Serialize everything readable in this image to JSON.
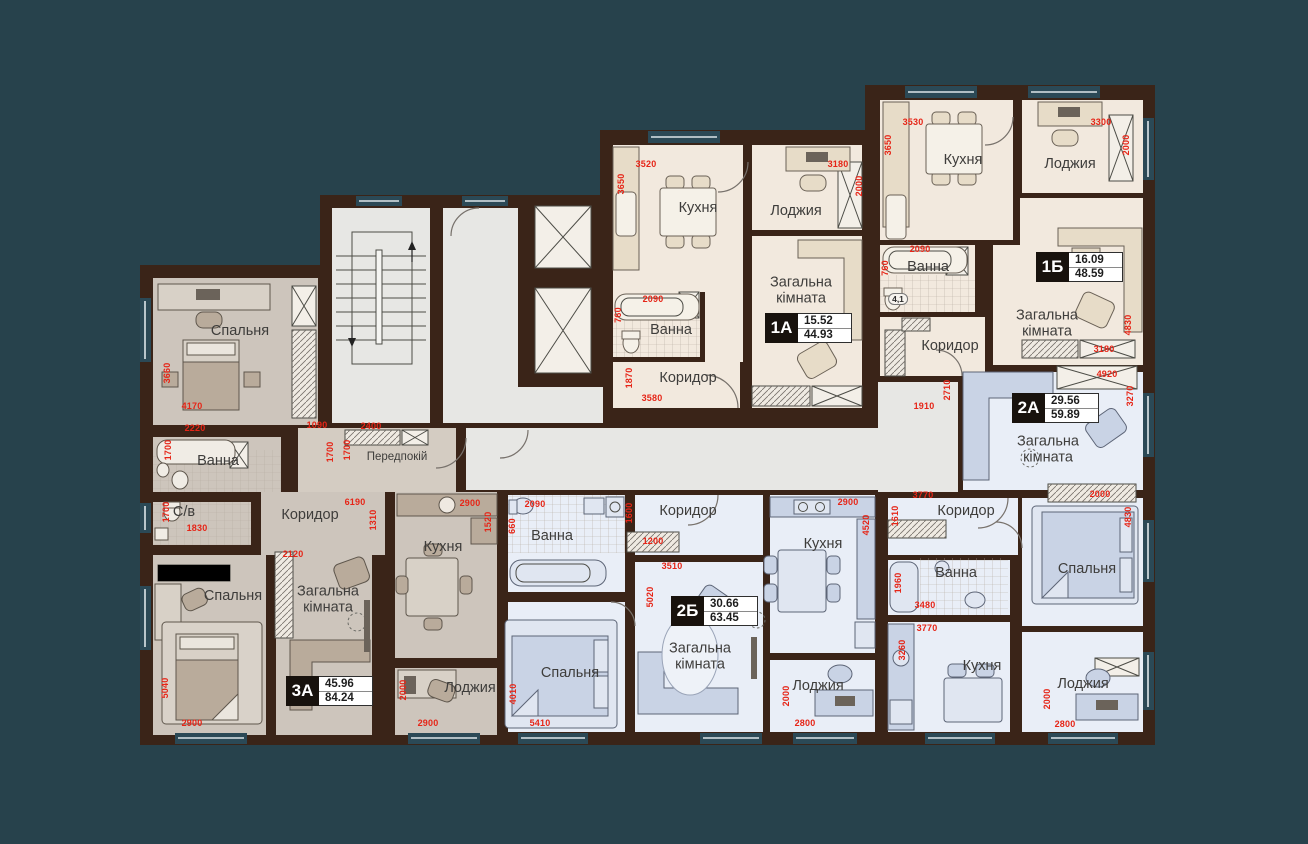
{
  "colors": {
    "background": "#27424c",
    "walls": "#3a2418",
    "dimension_red": "#e62517",
    "floor_beige": "#f2e9de",
    "floor_blue": "#e9eef7",
    "floor_warm_gray": "#cdc5bc",
    "floor_common": "#e7e7e4"
  },
  "apartments": [
    {
      "code": "1А",
      "living_area": "15.52",
      "total_area": "44.93"
    },
    {
      "code": "1Б",
      "living_area": "16.09",
      "total_area": "48.59"
    },
    {
      "code": "2А",
      "living_area": "29.56",
      "total_area": "59.89"
    },
    {
      "code": "2Б",
      "living_area": "30.66",
      "total_area": "63.45"
    },
    {
      "code": "3А",
      "living_area": "45.96",
      "total_area": "84.24"
    }
  ],
  "badges": [
    {
      "code": "1А",
      "living": "15.52",
      "total": "44.93",
      "x": 765,
      "y": 313
    },
    {
      "code": "1Б",
      "living": "16.09",
      "total": "48.59",
      "x": 1036,
      "y": 252
    },
    {
      "code": "2А",
      "living": "29.56",
      "total": "59.89",
      "x": 1012,
      "y": 393
    },
    {
      "code": "2Б",
      "living": "30.66",
      "total": "63.45",
      "x": 671,
      "y": 596
    },
    {
      "code": "3А",
      "living": "45.96",
      "total": "84.24",
      "x": 286,
      "y": 676
    }
  ],
  "room_labels": [
    {
      "t": "Кухня",
      "x": 698,
      "y": 209
    },
    {
      "t": "Лоджия",
      "x": 796,
      "y": 212
    },
    {
      "t": "Загальна\nкімната",
      "x": 801,
      "y": 291
    },
    {
      "t": "Ванна",
      "x": 671,
      "y": 331
    },
    {
      "t": "Коридор",
      "x": 688,
      "y": 379
    },
    {
      "t": "Кухня",
      "x": 963,
      "y": 161
    },
    {
      "t": "Лоджия",
      "x": 1070,
      "y": 165
    },
    {
      "t": "Загальна\nкімната",
      "x": 1047,
      "y": 324
    },
    {
      "t": "Ванна",
      "x": 928,
      "y": 268
    },
    {
      "t": "Коридор",
      "x": 950,
      "y": 347
    },
    {
      "t": "Загальна\nкімната",
      "x": 1048,
      "y": 450
    },
    {
      "t": "Коридор",
      "x": 966,
      "y": 512
    },
    {
      "t": "Ванна",
      "x": 956,
      "y": 574
    },
    {
      "t": "Кухня",
      "x": 982,
      "y": 667
    },
    {
      "t": "Спальня",
      "x": 1087,
      "y": 570
    },
    {
      "t": "Лоджия",
      "x": 1083,
      "y": 685
    },
    {
      "t": "Ванна",
      "x": 552,
      "y": 537
    },
    {
      "t": "Коридор",
      "x": 688,
      "y": 512
    },
    {
      "t": "Спальня",
      "x": 570,
      "y": 674
    },
    {
      "t": "Загальна\nкімната",
      "x": 700,
      "y": 657
    },
    {
      "t": "Кухня",
      "x": 823,
      "y": 545
    },
    {
      "t": "Лоджия",
      "x": 818,
      "y": 687
    },
    {
      "t": "Спальня",
      "x": 240,
      "y": 332
    },
    {
      "t": "Ванна",
      "x": 218,
      "y": 462
    },
    {
      "t": "С/в",
      "x": 184,
      "y": 513
    },
    {
      "t": "Коридор",
      "x": 310,
      "y": 516
    },
    {
      "t": "Спальня",
      "x": 233,
      "y": 597
    },
    {
      "t": "Загальна\nкімната",
      "x": 328,
      "y": 600
    },
    {
      "t": "Кухня",
      "x": 443,
      "y": 548
    },
    {
      "t": "Лоджия",
      "x": 470,
      "y": 689
    },
    {
      "t": "Передпокій",
      "x": 397,
      "y": 457,
      "s": 11.5
    }
  ],
  "misc_labels": [
    {
      "t": "4,1",
      "x": 898,
      "y": 299
    }
  ],
  "dim_labels": [
    {
      "t": "3520",
      "x": 646,
      "y": 164,
      "o": "h"
    },
    {
      "t": "3650",
      "x": 621,
      "y": 184,
      "o": "v"
    },
    {
      "t": "3180",
      "x": 838,
      "y": 164,
      "o": "h"
    },
    {
      "t": "2000",
      "x": 859,
      "y": 186,
      "o": "v"
    },
    {
      "t": "2090",
      "x": 653,
      "y": 299,
      "o": "h"
    },
    {
      "t": "760",
      "x": 618,
      "y": 315,
      "o": "v"
    },
    {
      "t": "1870",
      "x": 629,
      "y": 378,
      "o": "v"
    },
    {
      "t": "3580",
      "x": 652,
      "y": 398,
      "o": "h"
    },
    {
      "t": "3530",
      "x": 913,
      "y": 122,
      "o": "h"
    },
    {
      "t": "3650",
      "x": 888,
      "y": 145,
      "o": "v"
    },
    {
      "t": "3300",
      "x": 1101,
      "y": 122,
      "o": "h"
    },
    {
      "t": "2000",
      "x": 1126,
      "y": 145,
      "o": "v"
    },
    {
      "t": "2090",
      "x": 920,
      "y": 249,
      "o": "h"
    },
    {
      "t": "760",
      "x": 885,
      "y": 268,
      "o": "v"
    },
    {
      "t": "4830",
      "x": 1128,
      "y": 325,
      "o": "v"
    },
    {
      "t": "3180",
      "x": 1104,
      "y": 349,
      "o": "h"
    },
    {
      "t": "2710",
      "x": 947,
      "y": 390,
      "o": "v"
    },
    {
      "t": "1910",
      "x": 924,
      "y": 406,
      "o": "h"
    },
    {
      "t": "4920",
      "x": 1107,
      "y": 374,
      "o": "h"
    },
    {
      "t": "3270",
      "x": 1130,
      "y": 396,
      "o": "v"
    },
    {
      "t": "2000",
      "x": 1100,
      "y": 494,
      "o": "h"
    },
    {
      "t": "3770",
      "x": 923,
      "y": 495,
      "o": "h"
    },
    {
      "t": "1610",
      "x": 895,
      "y": 516,
      "o": "v"
    },
    {
      "t": "1960",
      "x": 898,
      "y": 583,
      "o": "v"
    },
    {
      "t": "3480",
      "x": 925,
      "y": 605,
      "o": "h"
    },
    {
      "t": "3770",
      "x": 927,
      "y": 628,
      "o": "h"
    },
    {
      "t": "3260",
      "x": 902,
      "y": 650,
      "o": "v"
    },
    {
      "t": "4830",
      "x": 1128,
      "y": 517,
      "o": "v"
    },
    {
      "t": "2000",
      "x": 1047,
      "y": 699,
      "o": "v"
    },
    {
      "t": "2800",
      "x": 1065,
      "y": 724,
      "o": "h"
    },
    {
      "t": "2090",
      "x": 535,
      "y": 504,
      "o": "h"
    },
    {
      "t": "660",
      "x": 512,
      "y": 526,
      "o": "v"
    },
    {
      "t": "1600",
      "x": 629,
      "y": 513,
      "o": "v"
    },
    {
      "t": "1200",
      "x": 653,
      "y": 541,
      "o": "h"
    },
    {
      "t": "3510",
      "x": 672,
      "y": 566,
      "o": "h"
    },
    {
      "t": "5020",
      "x": 650,
      "y": 597,
      "o": "v"
    },
    {
      "t": "2900",
      "x": 848,
      "y": 502,
      "o": "h"
    },
    {
      "t": "4520",
      "x": 866,
      "y": 525,
      "o": "v"
    },
    {
      "t": "4010",
      "x": 513,
      "y": 694,
      "o": "v"
    },
    {
      "t": "5410",
      "x": 540,
      "y": 723,
      "o": "h"
    },
    {
      "t": "2000",
      "x": 786,
      "y": 696,
      "o": "v"
    },
    {
      "t": "2800",
      "x": 805,
      "y": 723,
      "o": "h"
    },
    {
      "t": "3660",
      "x": 167,
      "y": 373,
      "o": "v"
    },
    {
      "t": "4170",
      "x": 192,
      "y": 406,
      "o": "h"
    },
    {
      "t": "2220",
      "x": 195,
      "y": 428,
      "o": "h"
    },
    {
      "t": "1700",
      "x": 168,
      "y": 450,
      "o": "v"
    },
    {
      "t": "1090",
      "x": 317,
      "y": 425,
      "o": "h"
    },
    {
      "t": "1700",
      "x": 330,
      "y": 452,
      "o": "v"
    },
    {
      "t": "1700",
      "x": 347,
      "y": 450,
      "o": "v"
    },
    {
      "t": "2400",
      "x": 371,
      "y": 426,
      "o": "h"
    },
    {
      "t": "6190",
      "x": 355,
      "y": 502,
      "o": "h"
    },
    {
      "t": "1310",
      "x": 373,
      "y": 520,
      "o": "v"
    },
    {
      "t": "1830",
      "x": 197,
      "y": 528,
      "o": "h"
    },
    {
      "t": "1700",
      "x": 166,
      "y": 512,
      "o": "v"
    },
    {
      "t": "2120",
      "x": 293,
      "y": 554,
      "o": "h"
    },
    {
      "t": "5040",
      "x": 165,
      "y": 688,
      "o": "v"
    },
    {
      "t": "2900",
      "x": 192,
      "y": 723,
      "o": "h"
    },
    {
      "t": "2900",
      "x": 470,
      "y": 503,
      "o": "h"
    },
    {
      "t": "1520",
      "x": 488,
      "y": 522,
      "o": "v"
    },
    {
      "t": "2000",
      "x": 403,
      "y": 690,
      "o": "v"
    },
    {
      "t": "2900",
      "x": 428,
      "y": 723,
      "o": "h"
    }
  ]
}
